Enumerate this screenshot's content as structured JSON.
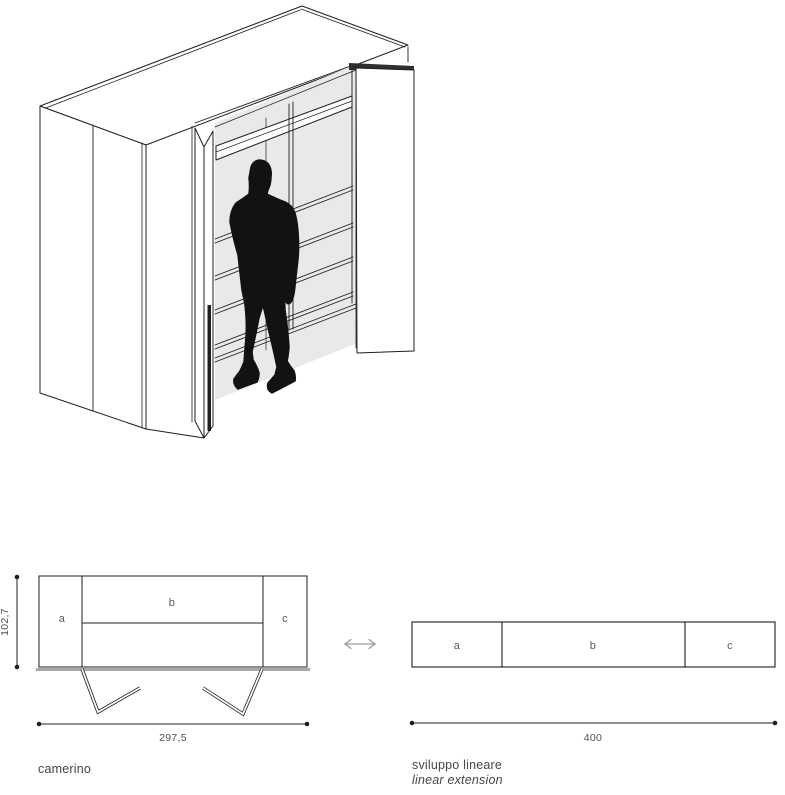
{
  "colors": {
    "background": "#ffffff",
    "line": "#1f1f1f",
    "interior_fill": "#e9e9e9",
    "silhouette_fill": "#121212",
    "label_text": "#5a5a5a",
    "dimension_text": "#4f4f4f",
    "caption_text": "#454545",
    "arrow": "#9b9b9b",
    "thick_base": "#a9a9a9"
  },
  "plan_view": {
    "caption": "camerino",
    "depth_dimension": "102,7",
    "width_dimension": "297,5",
    "sections": [
      {
        "label": "a"
      },
      {
        "label": "b"
      },
      {
        "label": "c"
      }
    ]
  },
  "linear_view": {
    "caption_primary": "sviluppo lineare",
    "caption_secondary": "linear extension",
    "width_dimension": "400",
    "sections": [
      {
        "label": "a"
      },
      {
        "label": "b"
      },
      {
        "label": "c"
      }
    ]
  }
}
